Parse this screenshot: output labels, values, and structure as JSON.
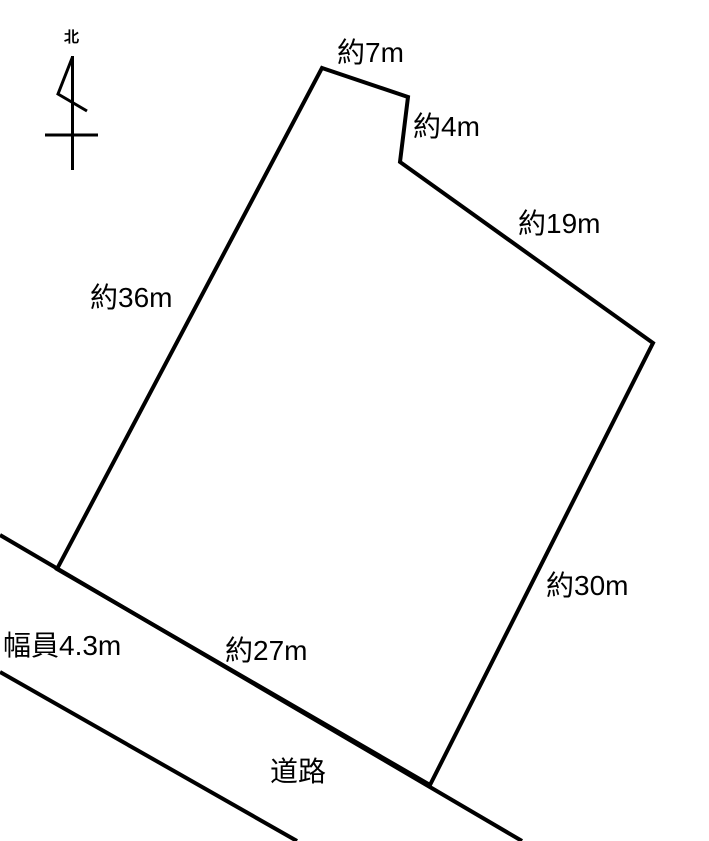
{
  "figure": {
    "type": "land-plot-survey-sketch",
    "background_color": "#ffffff",
    "ink_color": "#000000"
  },
  "compass": {
    "north_label": "北",
    "shaft_points": "72.5,56 72.5,170",
    "flag_points": "72.5,57 58,94 87,111",
    "crossbar_points": "45,135 98,135"
  },
  "parcel": {
    "outline_points": "322,68 408,97 400,162 653,343 430,785 57,569"
  },
  "road": {
    "upper_edge_points": "0,535 522,841",
    "lower_edge_points": "0,672 297,841",
    "name": "道路",
    "width_note": "幅員4.3m"
  },
  "dimension_labels": {
    "top_edge": "約7m",
    "notch_edge": "約4m",
    "northeast_edge": "約19m",
    "west_edge": "約36m",
    "southeast_edge": "約30m",
    "south_edge": "約27m"
  }
}
